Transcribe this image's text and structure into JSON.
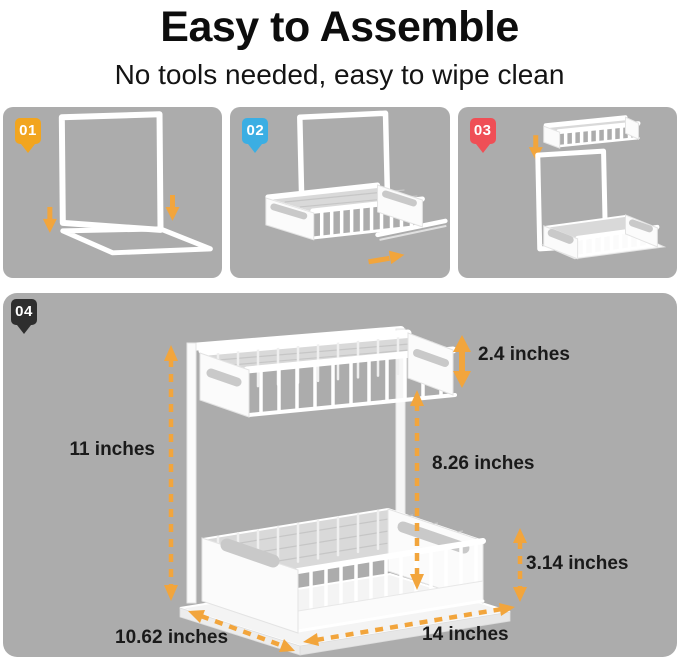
{
  "header": {
    "title": "Easy to Assemble",
    "subtitle": "No tools needed, easy to wipe clean"
  },
  "steps": [
    {
      "number": "01",
      "badge_color": "#F2A51F"
    },
    {
      "number": "02",
      "badge_color": "#3BAEE3"
    },
    {
      "number": "03",
      "badge_color": "#EF4F56"
    },
    {
      "number": "04",
      "badge_color": "#2E2E2E"
    }
  ],
  "dimensions": {
    "total_height": "11 inches",
    "top_basket_height": "2.4 inches",
    "tier_clearance": "8.26 inches",
    "bottom_basket_height": "3.14 inches",
    "depth": "10.62 inches",
    "width": "14 inches"
  },
  "colors": {
    "panel_background": "#ACACAC",
    "arrow": "#F2A53C",
    "product": "#FFFFFF"
  }
}
